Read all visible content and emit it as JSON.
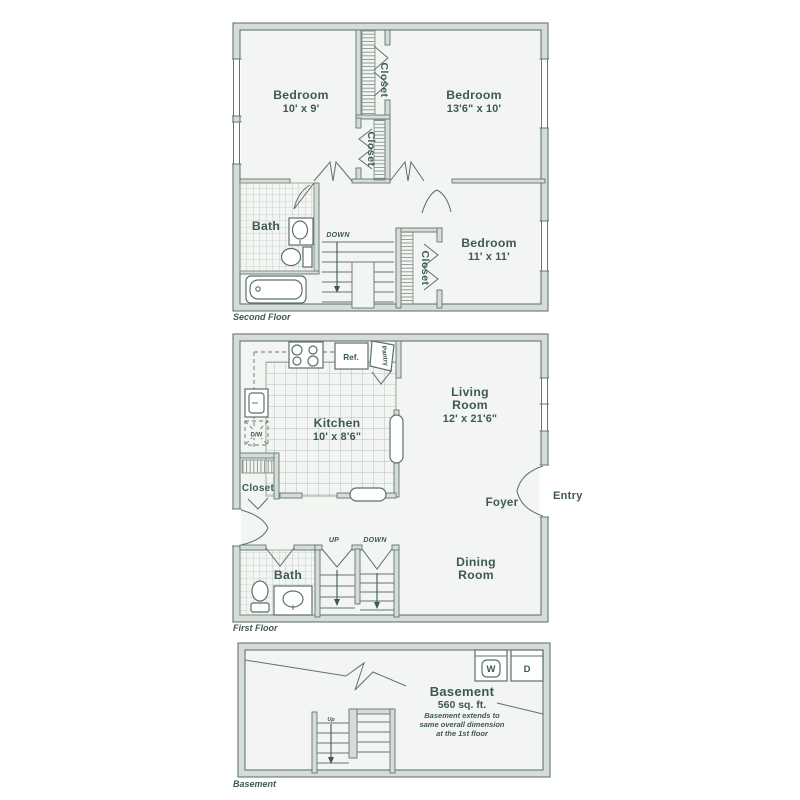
{
  "palette": {
    "ink": "#3d5a50",
    "wall_fill": "#d6dcd7",
    "wall_edge": "#64786f",
    "floor_fill": "#f3f5f2",
    "tile_line": "#a9b5ae",
    "fixture_line": "#5c7168",
    "background": "#ffffff"
  },
  "floors": {
    "second": {
      "label": "Second Floor",
      "bedroom1": {
        "name": "Bedroom",
        "dims": "10' x 9'"
      },
      "bedroom2": {
        "name": "Bedroom",
        "dims": "13'6\" x 10'"
      },
      "bedroom3": {
        "name": "Bedroom",
        "dims": "11' x 11'"
      },
      "bath_label": "Bath",
      "closet_upper": "Closet",
      "closet_lower": "Closet",
      "closet_bedroom3": "Closet",
      "stairs_down": "DOWN"
    },
    "first": {
      "label": "First Floor",
      "kitchen": {
        "name": "Kitchen",
        "dims": "10' x 8'6\""
      },
      "living": {
        "line1": "Living",
        "line2": "Room",
        "dims": "12' x 21'6\""
      },
      "dining": {
        "line1": "Dining",
        "line2": "Room"
      },
      "foyer": "Foyer",
      "entry": "Entry",
      "bath_label": "Bath",
      "closet": "Closet",
      "pantry": "Pantry",
      "fridge": "Ref.",
      "dishwasher": "D/W",
      "stairs_up": "UP",
      "stairs_down": "DOWN"
    },
    "basement": {
      "label": "Basement",
      "title": "Basement",
      "area": "560 sq. ft.",
      "note1": "Basement extends to",
      "note2": "same overall dimension",
      "note3": "at the 1st floor",
      "washer": "W",
      "dryer": "D",
      "stairs_up": "Up"
    }
  }
}
